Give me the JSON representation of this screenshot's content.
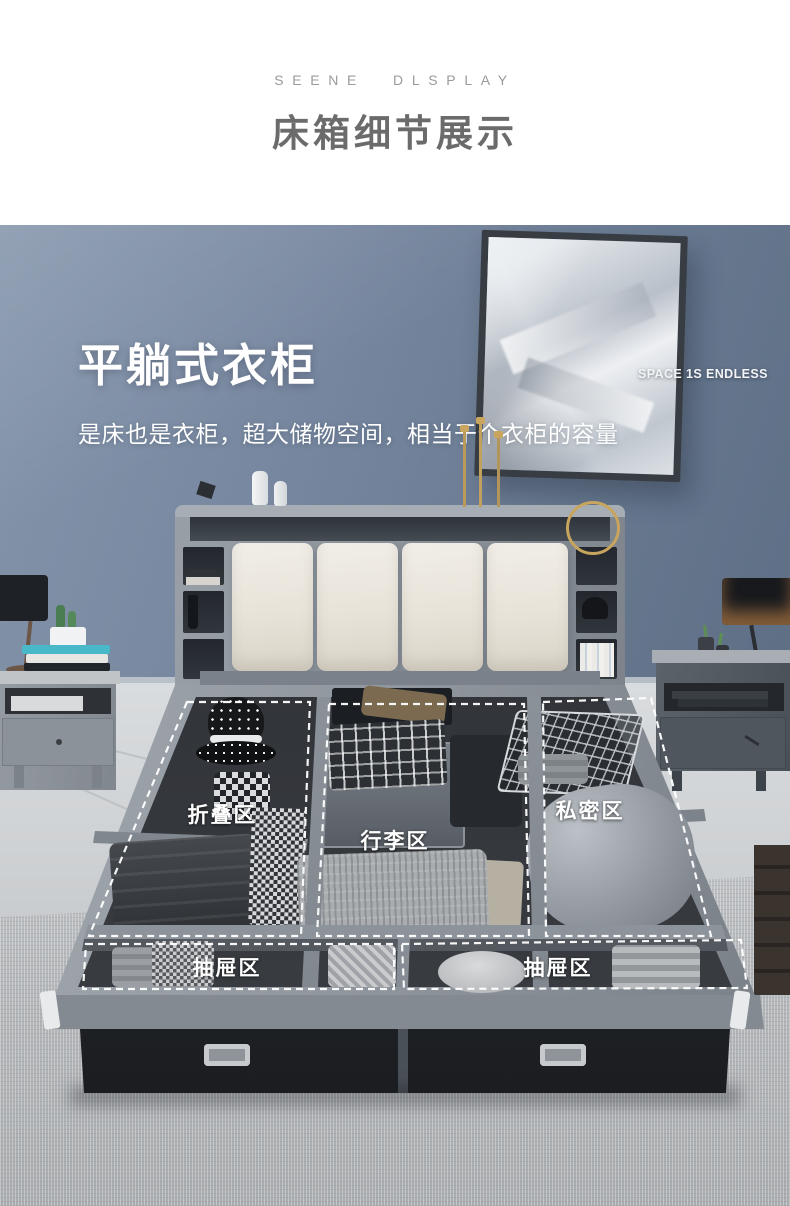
{
  "header": {
    "eyebrow": "SEENE DLSPLAY",
    "title": "床箱细节展示"
  },
  "hero": {
    "headline": "平躺式衣柜",
    "subheadline": "是床也是衣柜，超大储物空间，相当于个衣柜的容量"
  },
  "painting": {
    "caption": "SPACE 1S ENDLESS"
  },
  "zones": {
    "fold": {
      "label": "折叠区"
    },
    "luggage": {
      "label": "行李区"
    },
    "private": {
      "label": "私密区"
    },
    "drawer_left": {
      "label": "抽屉区"
    },
    "drawer_right": {
      "label": "抽屉区"
    }
  },
  "colors": {
    "wall": "#72829a",
    "title_text": "#6b6b6b",
    "eyebrow_text": "#9b9b9b",
    "overlay_text": "#ffffff",
    "cushion": "#eae6dc",
    "bed_fabric": "#9299a1",
    "box_interior": "#2f3237",
    "drawer_front": "#202327",
    "carpet": "#b5b8bb",
    "painting_frame": "#383d44"
  }
}
